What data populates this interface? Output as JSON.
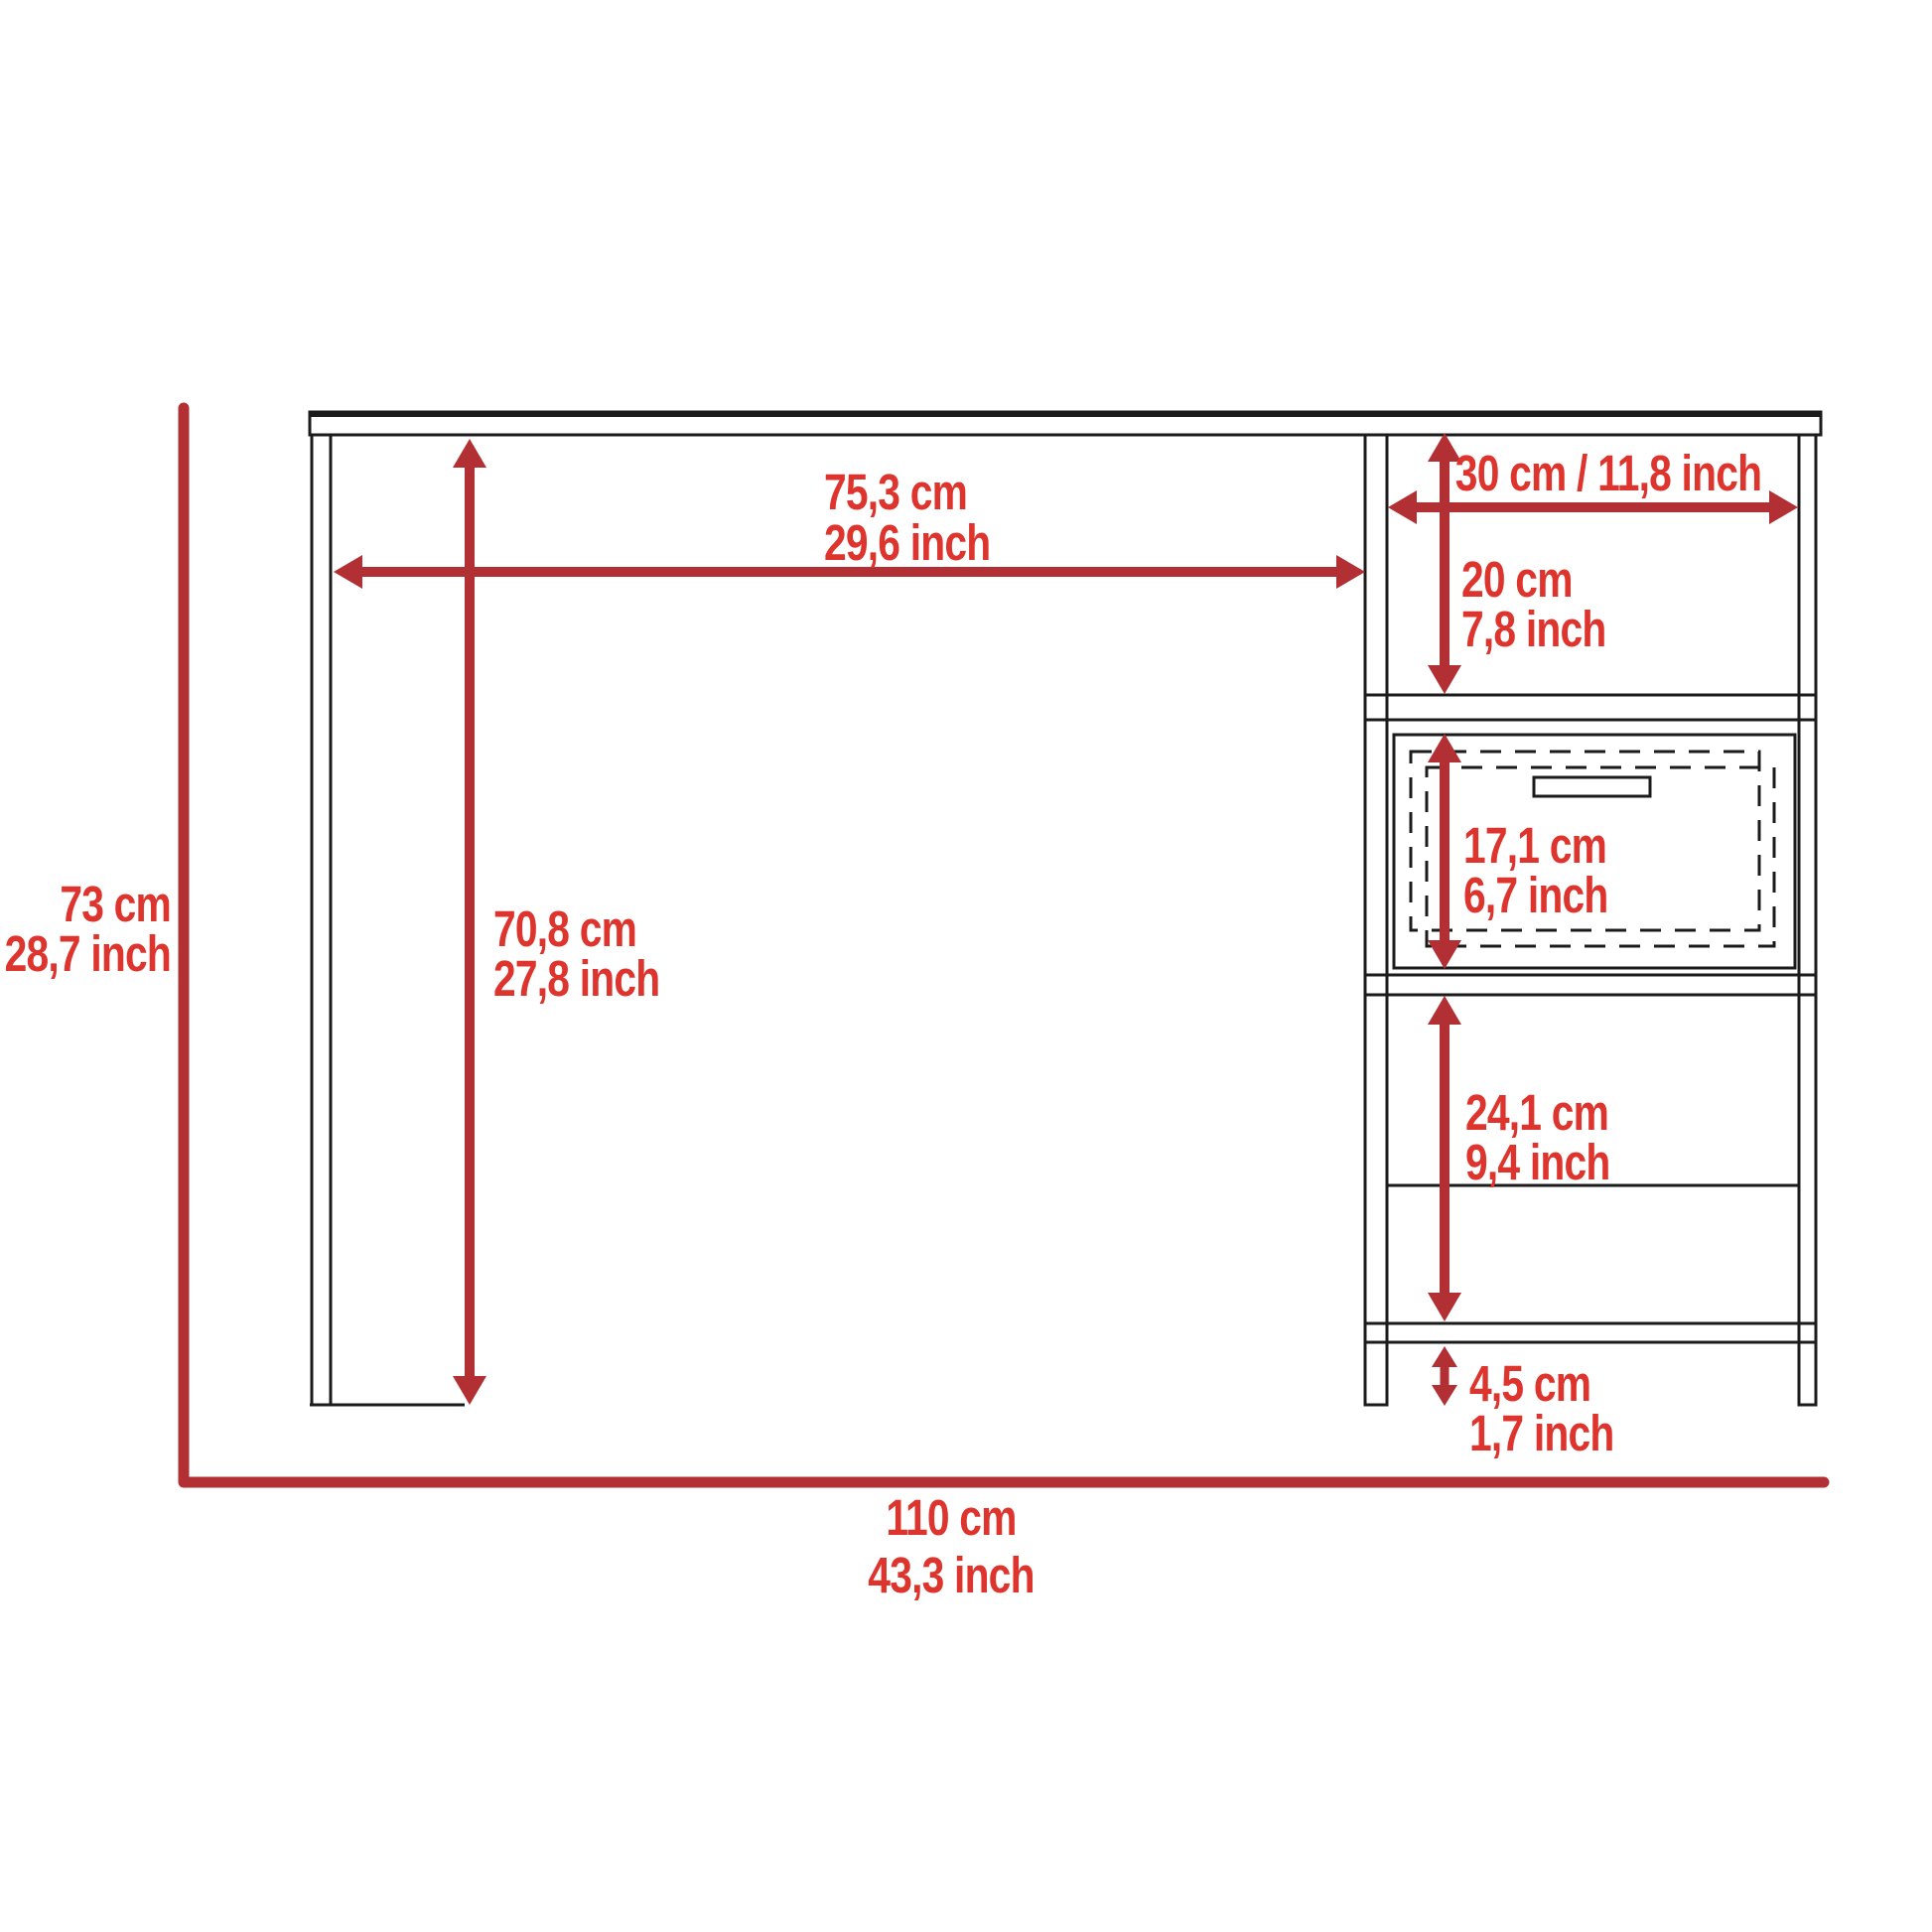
{
  "diagram": {
    "labels": {
      "desk_top_width": {
        "cm": "75,3 cm",
        "inch": "29,6 inch"
      },
      "hutch_width": {
        "combined": "30 cm / 11,8 inch"
      },
      "top_cubby_height": {
        "cm": "20 cm",
        "inch": "7,8 inch"
      },
      "drawer_height": {
        "cm": "17,1 cm",
        "inch": "6,7 inch"
      },
      "shelf_section_height": {
        "cm": "24,1 cm",
        "inch": "9,4 inch"
      },
      "leg_height": {
        "cm": "4,5 cm",
        "inch": "1,7 inch"
      },
      "overall_height": {
        "cm": "73 cm",
        "inch": "28,7 inch"
      },
      "clearance_height": {
        "cm": "70,8 cm",
        "inch": "27,8 inch"
      },
      "overall_width": {
        "cm": "110 cm",
        "inch": "43,3 inch"
      }
    },
    "colors": {
      "dimension_line_red": "#b23034",
      "label_text_red": "#de342e",
      "outline_black": "#1b1b1b",
      "background": "#ffffff"
    }
  }
}
